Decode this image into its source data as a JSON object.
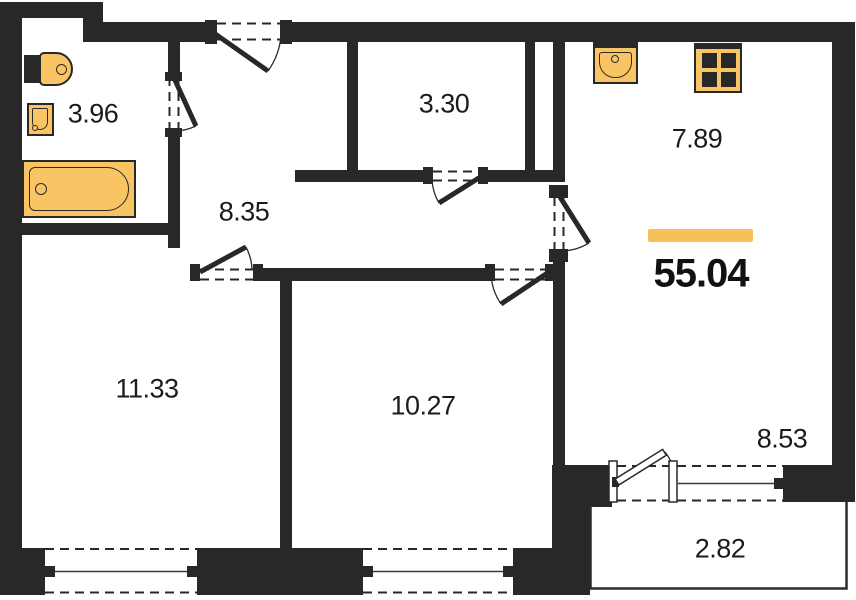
{
  "plan": {
    "total_area": "55.04",
    "rooms": {
      "bathroom": "3.96",
      "hallway": "8.35",
      "toilet_room": "3.30",
      "kitchen": "7.89",
      "bedroom": "11.33",
      "second_room": "10.27",
      "living_zone": "8.53",
      "balcony": "2.82"
    },
    "fixtures": [
      "toilet",
      "wash-basin",
      "bathtub",
      "kitchen-sink",
      "stove"
    ],
    "colors": {
      "wall": "#282828",
      "fixture_fill": "#f9c564",
      "accent_bar": "#f6c257",
      "background": "#ffffff",
      "text": "#1b1b1b"
    }
  }
}
